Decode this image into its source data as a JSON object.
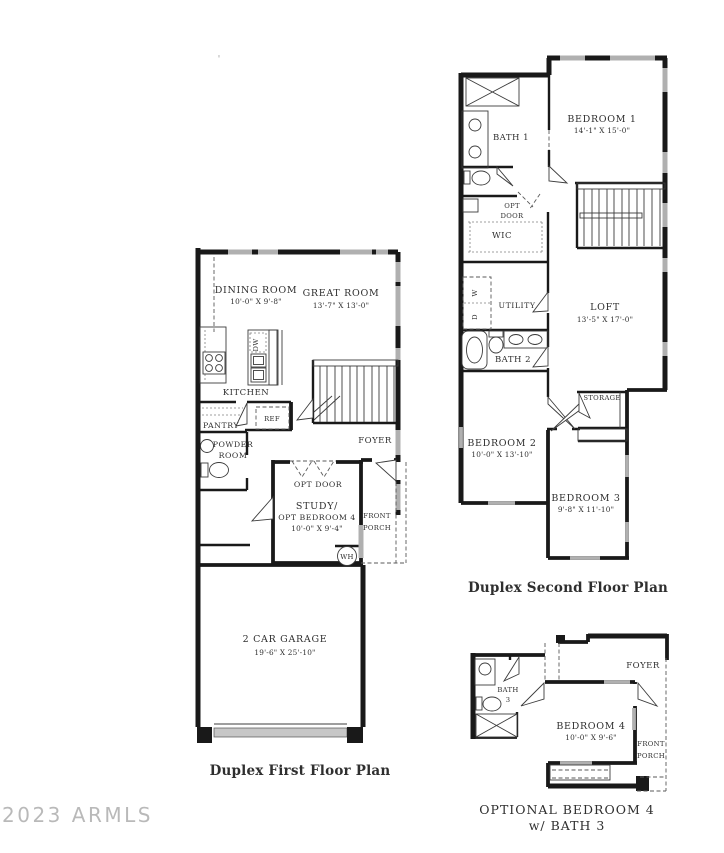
{
  "meta": {
    "watermark": "2023 ARMLS",
    "artifact_mark": "'"
  },
  "first_floor": {
    "caption": "Duplex First Floor Plan",
    "labels": {
      "dining_name": "DINING ROOM",
      "dining_dims": "10'-0\" X 9'-8\"",
      "great_name": "GREAT ROOM",
      "great_dims": "13'-7\" X 13'-0\"",
      "kitchen": "KITCHEN",
      "pantry": "PANTRY",
      "ref": "REF",
      "dw": "DW",
      "powder_1": "POWDER",
      "powder_2": "ROOM",
      "foyer": "FOYER",
      "opt_door": "OPT DOOR",
      "study_1": "STUDY/",
      "study_2": "OPT BEDROOM 4",
      "study_dims": "10'-0\" X 9'-4\"",
      "porch_1": "FRONT",
      "porch_2": "PORCH",
      "wh": "WH",
      "garage_name": "2 CAR GARAGE",
      "garage_dims": "19'-6\" X 25'-10\""
    }
  },
  "second_floor": {
    "caption": "Duplex Second Floor Plan",
    "labels": {
      "bath1": "BATH 1",
      "bedroom1_name": "BEDROOM 1",
      "bedroom1_dims": "14'-1\" X 15'-0\"",
      "opt_1": "OPT",
      "opt_2": "DOOR",
      "wic": "WIC",
      "washer": "W",
      "dryer": "D",
      "utility": "UTILITY",
      "bath2": "BATH 2",
      "loft_name": "LOFT",
      "loft_dims": "13'-5\" X 17'-0\"",
      "storage": "STORAGE",
      "bedroom2_name": "BEDROOM 2",
      "bedroom2_dims": "10'-0\" X 13'-10\"",
      "bedroom3_name": "BEDROOM 3",
      "bedroom3_dims": "9'-8\" X 11'-10\""
    }
  },
  "optional_bedroom": {
    "caption_1": "OPTIONAL BEDROOM 4",
    "caption_2": "w/ BATH 3",
    "labels": {
      "bath3_1": "BATH",
      "bath3_2": "3",
      "foyer": "FOYER",
      "bedroom4_name": "BEDROOM 4",
      "bedroom4_dims": "10'-0\" X 9'-6\"",
      "porch_1": "FRONT",
      "porch_2": "PORCH"
    }
  }
}
